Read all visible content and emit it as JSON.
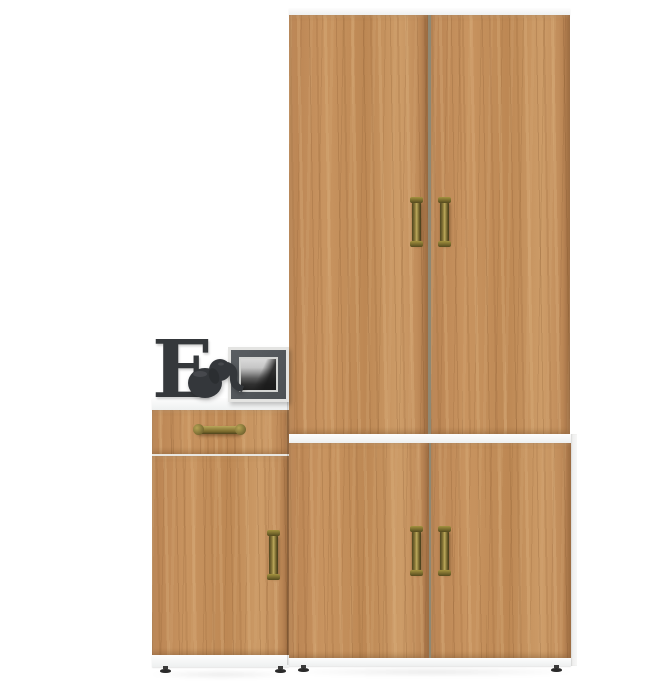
{
  "scene": {
    "subject": "Oak-finish wardrobe and low chest product photo with decor items",
    "background": "#ffffff"
  },
  "palette": {
    "wood_mid": "#c08a55",
    "wood_light": "#d9b183",
    "wood_dark": "#8a5c33",
    "panel_white": "#f5f6f6",
    "door_gap": "#8f8873",
    "handle_brass": "#8d7c3b",
    "handle_brass_dark": "#4e441d",
    "decor_charcoal": "#35383b",
    "photo_mat_gray": "#53575b",
    "foot_black": "#2b2b2b"
  },
  "wardrobe": {
    "name": "tall two-section wardrobe with four oak doors",
    "handle_count": "4"
  },
  "chest": {
    "name": "low chest with one drawer and one door",
    "handle_count": "2"
  },
  "decor": {
    "letter": "E",
    "figurine": "elephant figurine",
    "photo_frame": "framed black-and-white seascape photo"
  }
}
